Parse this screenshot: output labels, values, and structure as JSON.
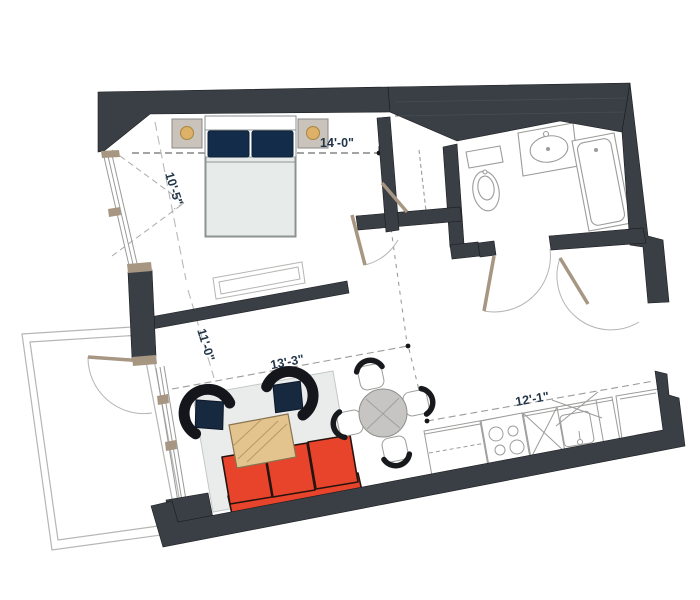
{
  "dimensions": {
    "bedroom_width": "14'-0\"",
    "bedroom_depth": "10'-5\"",
    "living_width": "11'-0\"",
    "living_length": "13'-3\"",
    "kitchen_length": "12'-1\""
  },
  "colors": {
    "wall": "#3a3f45",
    "wall_panel_line": "#474d53",
    "door": "#a79682",
    "window_frame": "#9a9a98",
    "fixture_line": "#9c9c9a",
    "arc": "#b5b5b3",
    "rug": "#e9eceb",
    "sofa": "#e8432b",
    "armchair_shell": "#14161c",
    "armchair_cushion": "#16293f",
    "coffee_table": "#e3c48e",
    "coffee_table_edge": "#8a7350",
    "dining_table": "#c6c5c3",
    "bed_duvet": "#e7ebea",
    "pillow": "#122c4a",
    "nightstand": "#c9c3bc",
    "lamp": "#ddb167",
    "dimension_text": "#233649",
    "dimension_line": "#9b9b99"
  }
}
